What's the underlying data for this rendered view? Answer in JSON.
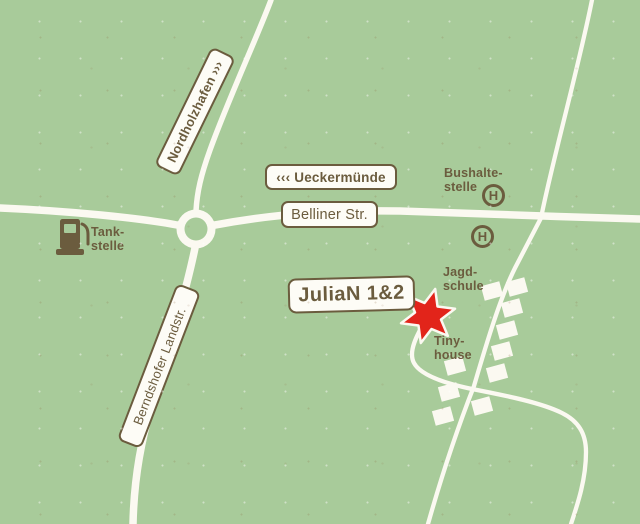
{
  "colors": {
    "background": "#a8cb9a",
    "road": "#fbf9f1",
    "paper": "#fdfcf6",
    "ink": "#6b5c3e",
    "star": "#e2241a"
  },
  "road_labels": {
    "nordholzhafen": "Nordholzhafen ›››",
    "ueckermuende": "‹‹‹ Ueckermünde",
    "belliner": "Belliner Str.",
    "berndshofer": "Berndshofer Landstr."
  },
  "markers": {
    "julian": "JuliaN 1&2",
    "bus_stop_symbol": "H",
    "tankstelle": {
      "line1": "Tank-",
      "line2": "stelle"
    },
    "bushaltestelle": {
      "line1": "Bushalte-",
      "line2": "stelle"
    },
    "jagdschule": {
      "line1": "Jagd-",
      "line2": "schule"
    },
    "tinyhouse": {
      "line1": "Tiny-",
      "line2": "house"
    }
  }
}
